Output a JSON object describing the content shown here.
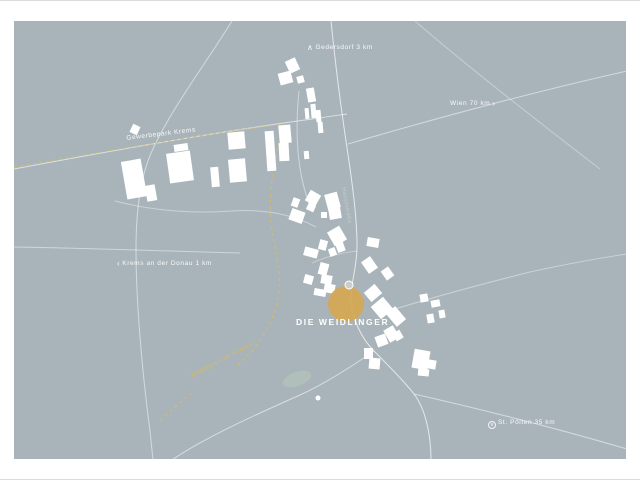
{
  "title": "DIE WEIDLINGER",
  "colors": {
    "map_bg": "#a9b4ba",
    "accent": "#d6a751",
    "boundary": "#d3bc6a",
    "pond": "#b0bfba",
    "building": "#ffffff",
    "frame": "#ffffff"
  },
  "direction_labels": {
    "north": {
      "arrow": "∧",
      "text": "Gedersdorf 3 km"
    },
    "east": {
      "text": "Wien 70 km",
      "arrow": "›"
    },
    "west": {
      "arrow": "‹",
      "text": "Krems an der Donau 1 km"
    },
    "south": {
      "arrow": "∨",
      "text": "St. Pölten 35 km"
    }
  },
  "area_labels": {
    "industrial_park": "Gewerbepark Krems",
    "city_boundary": "Stadtgrenze Krems",
    "road": "Hauptstraße"
  },
  "map_geometry": {
    "roads": [
      {
        "d": "M 331 20 C 336 70 340 100 346 140 C 352 180 357 215 357 245 C 357 268 350 284 351 300 C 352 318 362 338 374 350 C 388 364 404 380 414 393 C 424 406 431 430 431 459",
        "o": 0.7
      },
      {
        "d": "M 348 143 C 420 122 520 94 627 70",
        "o": 0.5
      },
      {
        "d": "M 415 20 C 468 66 540 122 600 168",
        "o": 0.35
      },
      {
        "d": "M 14 168 C 100 152 220 130 320 117 C 331 115 340 114 347 113",
        "o": 0.6
      },
      {
        "d": "M 232 20 C 202 68 170 110 152 150 C 140 176 136 210 136 248 C 136 300 142 370 150 430 L 153 459",
        "o": 0.5
      },
      {
        "d": "M 14 246 C 80 247 170 250 240 252",
        "o": 0.45
      },
      {
        "d": "M 374 350 C 348 368 322 384 300 394 C 262 411 205 436 172 459",
        "o": 0.55
      },
      {
        "d": "M 414 393 C 480 408 552 426 627 448",
        "o": 0.5
      },
      {
        "d": "M 382 312 C 430 297 482 283 530 271 C 562 264 600 257 627 253",
        "o": 0.4
      },
      {
        "d": "M 115 200 C 150 209 190 213 232 210 C 262 208 290 212 316 226",
        "o": 0.4
      },
      {
        "d": "M 299 90 C 296 120 296 150 302 178 C 305 192 308 200 312 210",
        "o": 0.45
      },
      {
        "d": "M 357 250 C 340 252 325 256 312 262",
        "o": 0.35
      }
    ],
    "boundary_paths": [
      {
        "d": "M 14 166 C 100 151 200 134 284 123 C 276 150 268 185 271 220 C 274 252 284 272 277 302 C 272 325 256 348 238 364"
      },
      {
        "d": "M 192 392 C 180 402 168 412 158 421"
      }
    ],
    "buildings": [
      [
        124,
        159,
        20,
        38,
        -10
      ],
      [
        146,
        184,
        10,
        16,
        -10
      ],
      [
        168,
        151,
        24,
        30,
        -8
      ],
      [
        174,
        143,
        14,
        7,
        -8
      ],
      [
        211,
        166,
        8,
        20,
        -5
      ],
      [
        229,
        158,
        17,
        23,
        -5
      ],
      [
        228,
        131,
        17,
        17,
        -5
      ],
      [
        266,
        130,
        9,
        40,
        -4
      ],
      [
        131,
        124,
        8,
        9,
        25
      ],
      [
        287,
        58,
        11,
        13,
        -25
      ],
      [
        279,
        71,
        13,
        12,
        -15
      ],
      [
        297,
        75,
        7,
        7,
        -15
      ],
      [
        307,
        87,
        8,
        14,
        -10
      ],
      [
        311,
        103,
        5,
        14,
        -5
      ],
      [
        305,
        107,
        4,
        11,
        -5
      ],
      [
        316,
        109,
        5,
        12,
        -5
      ],
      [
        318,
        121,
        5,
        11,
        -5
      ],
      [
        279,
        124,
        12,
        18,
        -5
      ],
      [
        279,
        142,
        10,
        18,
        -3
      ],
      [
        304,
        150,
        5,
        8,
        -5
      ],
      [
        307,
        191,
        12,
        12,
        30
      ],
      [
        326,
        192,
        13,
        16,
        -15
      ],
      [
        292,
        197,
        7,
        9,
        20
      ],
      [
        307,
        203,
        8,
        7,
        25
      ],
      [
        290,
        209,
        14,
        12,
        20
      ],
      [
        329,
        207,
        12,
        11,
        -10
      ],
      [
        321,
        211,
        6,
        6,
        0
      ],
      [
        330,
        227,
        14,
        16,
        -30
      ],
      [
        319,
        239,
        8,
        10,
        15
      ],
      [
        336,
        239,
        8,
        12,
        -20
      ],
      [
        304,
        247,
        14,
        9,
        15
      ],
      [
        329,
        247,
        7,
        8,
        -20
      ],
      [
        367,
        237,
        12,
        9,
        10
      ],
      [
        319,
        262,
        9,
        12,
        15
      ],
      [
        364,
        257,
        11,
        14,
        -35
      ],
      [
        383,
        267,
        9,
        11,
        -35
      ],
      [
        304,
        274,
        9,
        9,
        15
      ],
      [
        321,
        274,
        11,
        9,
        10
      ],
      [
        324,
        283,
        11,
        9,
        10
      ],
      [
        314,
        288,
        12,
        7,
        10
      ],
      [
        366,
        286,
        14,
        12,
        -40
      ],
      [
        374,
        299,
        16,
        16,
        -40
      ],
      [
        390,
        307,
        12,
        17,
        -40
      ],
      [
        386,
        326,
        11,
        14,
        -30
      ],
      [
        376,
        334,
        11,
        11,
        -20
      ],
      [
        394,
        330,
        8,
        9,
        -30
      ],
      [
        364,
        347,
        9,
        11,
        0
      ],
      [
        369,
        357,
        11,
        11,
        5
      ],
      [
        413,
        349,
        16,
        19,
        10
      ],
      [
        428,
        359,
        8,
        9,
        10
      ],
      [
        418,
        368,
        11,
        7,
        5
      ],
      [
        420,
        293,
        8,
        8,
        -10
      ],
      [
        431,
        299,
        9,
        7,
        -10
      ],
      [
        427,
        313,
        7,
        9,
        -10
      ],
      [
        439,
        309,
        6,
        8,
        -10
      ]
    ],
    "pond": {
      "cx": 297,
      "cy": 378,
      "rx": 15,
      "ry": 7,
      "rot": -20
    },
    "site_marker": {
      "cx": 346,
      "cy": 303,
      "r": 18
    },
    "gray_dot": {
      "cx": 349,
      "cy": 284,
      "r": 4
    },
    "junction_dot": {
      "cx": 318,
      "cy": 397,
      "r": 2.5
    }
  }
}
